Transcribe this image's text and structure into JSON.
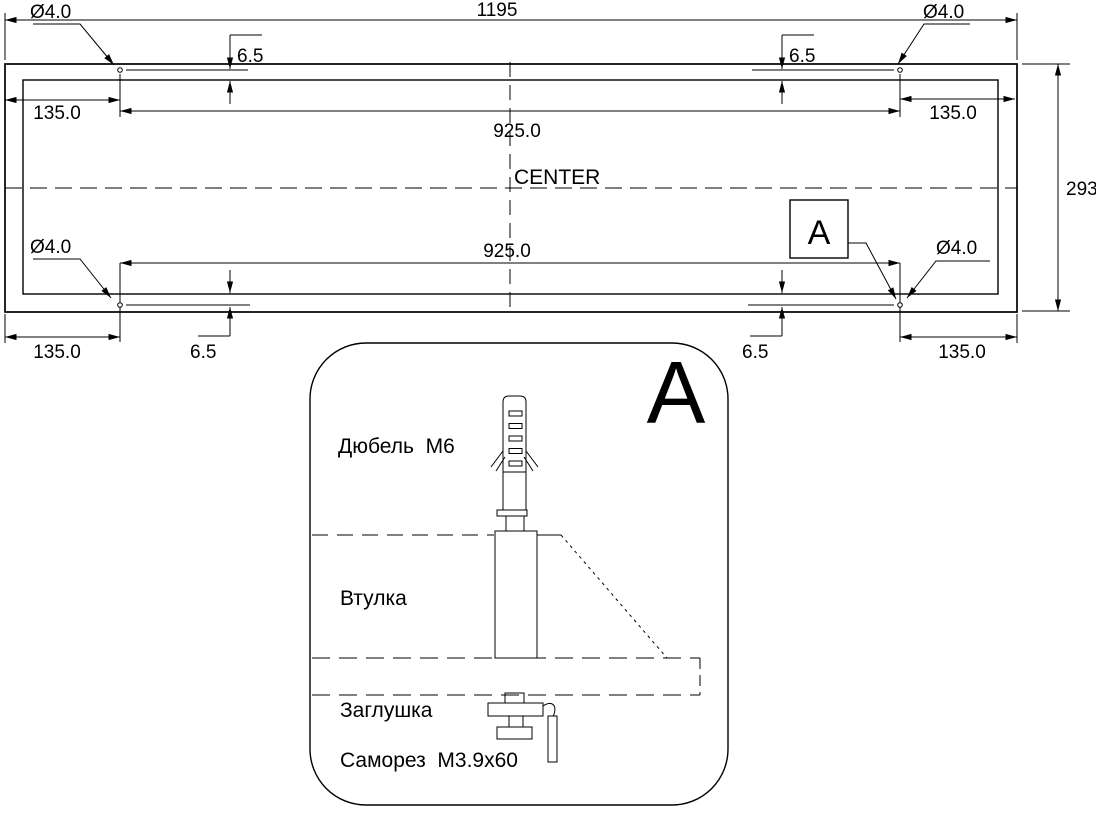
{
  "colors": {
    "ink": "#000000",
    "paper": "#ffffff"
  },
  "main_view": {
    "dim_overall_width": "1195",
    "dim_overall_height": "293",
    "dim_hole_spacing": "925.0",
    "dim_edge_offset": "135.0",
    "dim_hole_offset": "6.5",
    "dim_hole_diameter": "Ø4.0",
    "center_line_label": "CENTER",
    "detail_callout_label": "A"
  },
  "detail_view": {
    "view_label": "A",
    "part_labels": {
      "dowel": "Дюбель  M6",
      "bushing": "Втулка",
      "plug": "Заглушка",
      "screw": "Саморез  M3.9x60"
    }
  }
}
